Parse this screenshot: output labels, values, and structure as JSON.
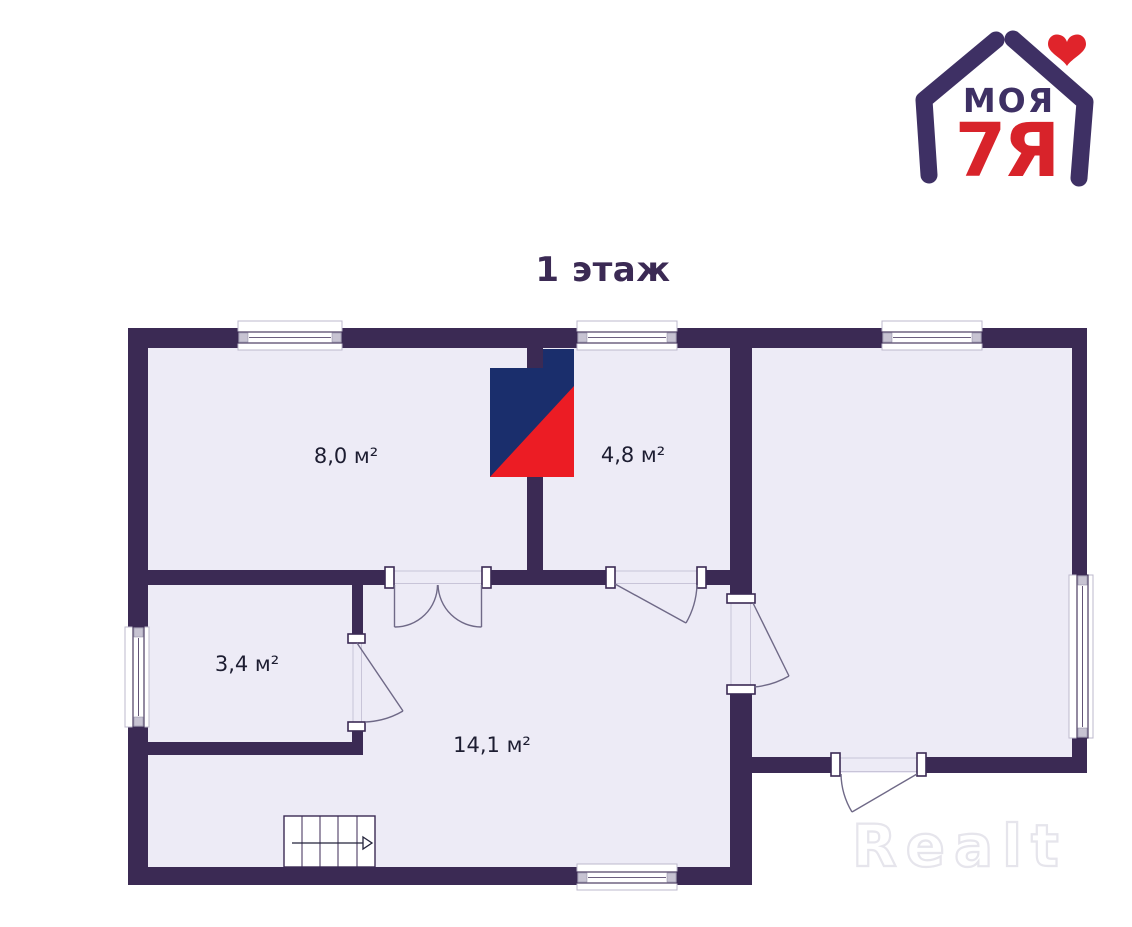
{
  "title": "1 этаж",
  "logo": {
    "text_top": "МОЯ",
    "text_bottom": "7Я",
    "heart_icon": "heart",
    "color_purple": "#3E3064",
    "color_red": "#D8232A"
  },
  "watermark": {
    "text": "Realt",
    "color": "#E6E5EC"
  },
  "floor_plan": {
    "colors": {
      "wall": "#3B2A54",
      "room_fill": "#EDEBF6",
      "stove_navy": "#1A2E6C",
      "stove_red": "#EC1C24",
      "door_swing": "#6F6987"
    },
    "rooms": [
      {
        "id": "top-left",
        "area_label": "8,0 м²"
      },
      {
        "id": "top-middle",
        "area_label": "4,8 м²"
      },
      {
        "id": "side-left",
        "area_label": "3,4 м²"
      },
      {
        "id": "hall",
        "area_label": "14,1 м²"
      },
      {
        "id": "right",
        "area_label": ""
      }
    ],
    "stairs": {
      "treads": 5,
      "direction_icon": "arrow-right"
    }
  }
}
